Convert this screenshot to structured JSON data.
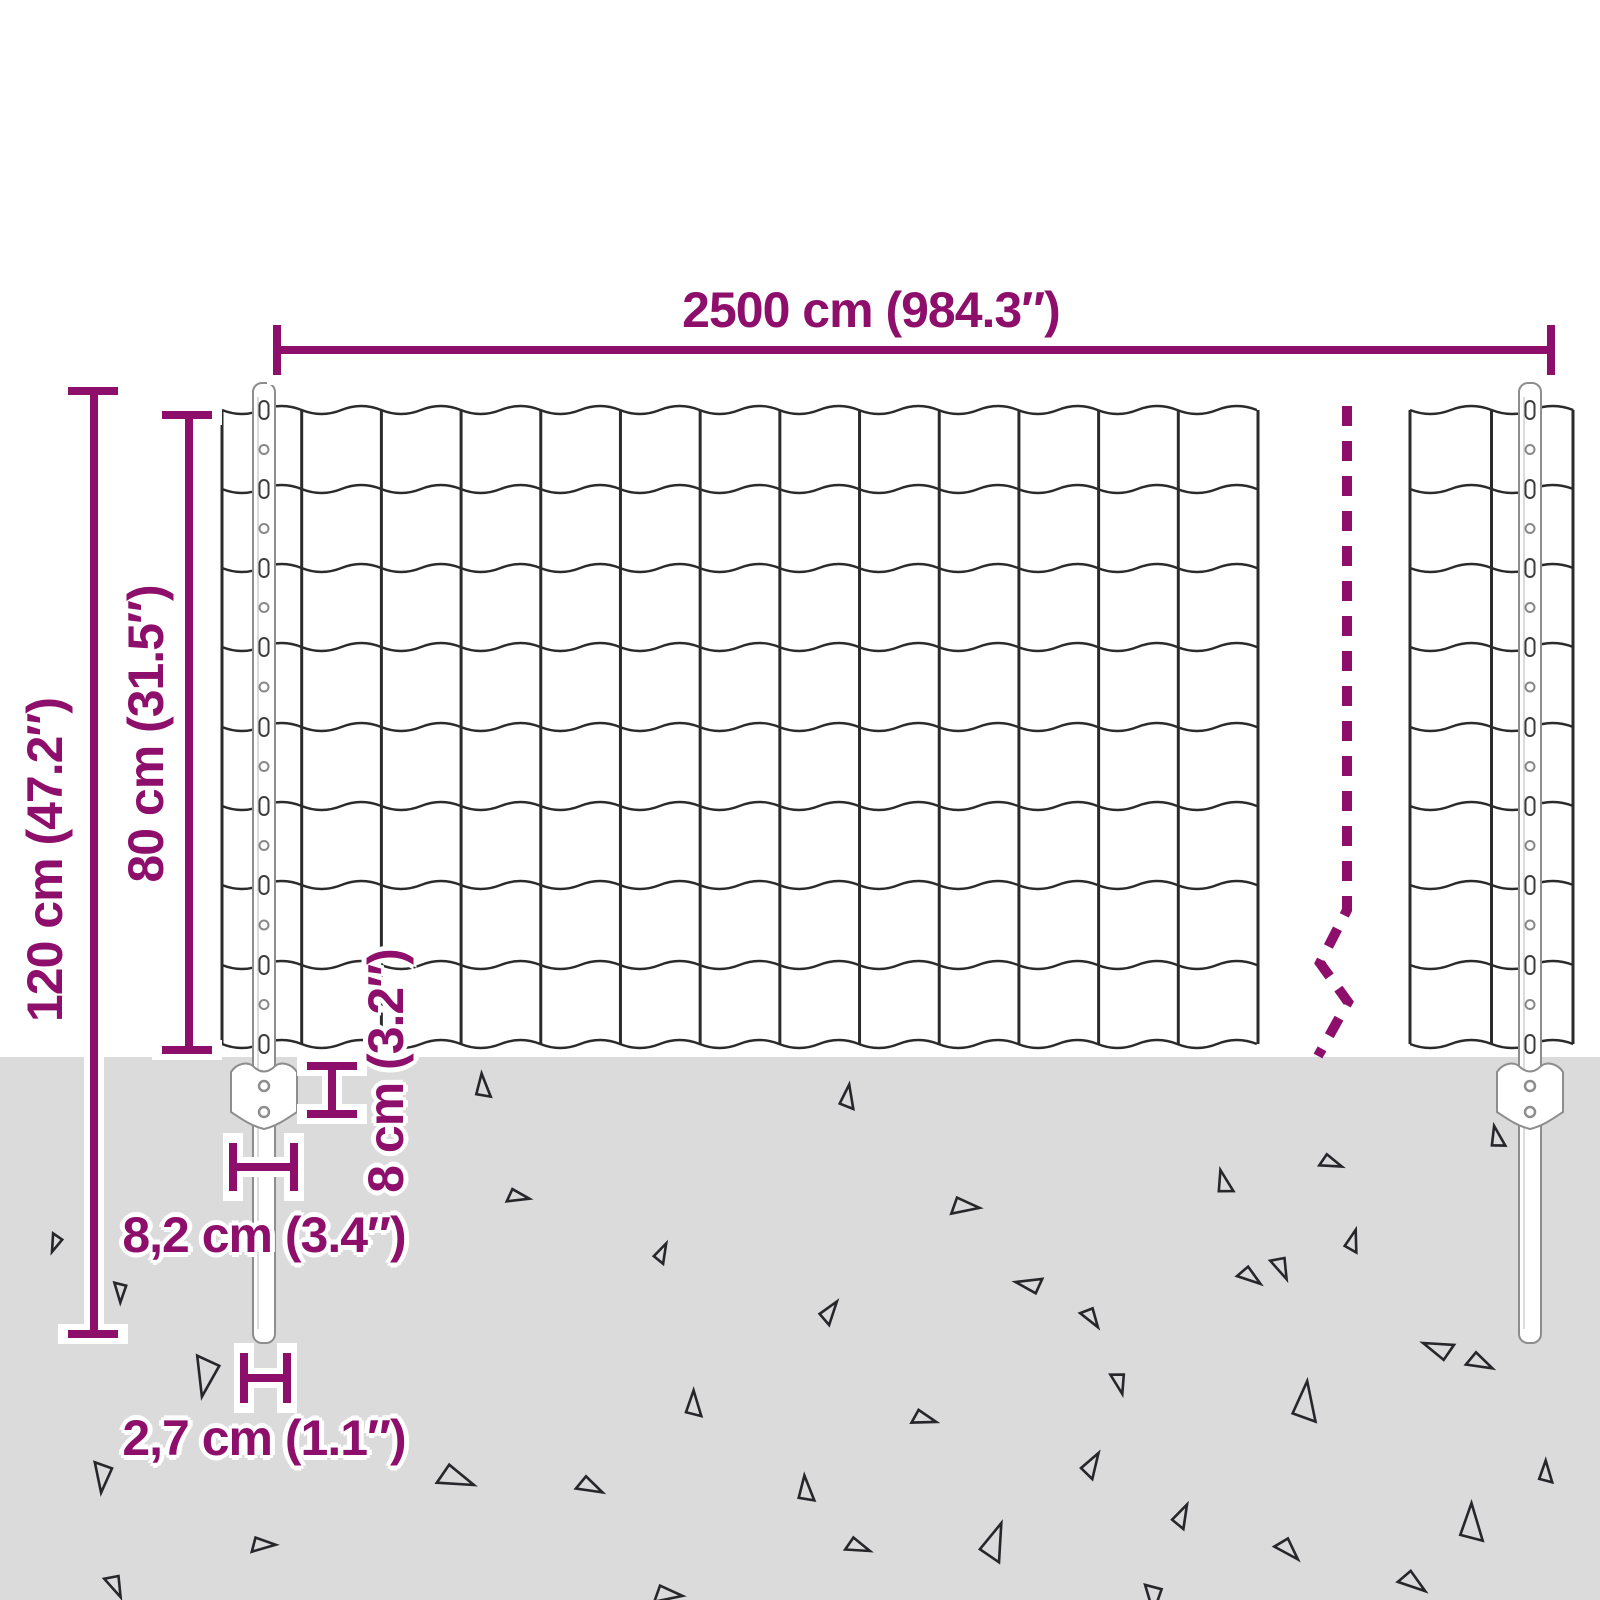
{
  "page": {
    "title": "Fence dimension diagram"
  },
  "labels": {
    "length": "2500 cm (984.3″)",
    "total_height": "120 cm (47.2″)",
    "mesh_height": "80 cm (31.5″)",
    "anchor_depth": "8 cm (3.2″)",
    "anchor_width": "8,2 cm (3.4″)",
    "post_width": "2,7 cm (1.1″)"
  },
  "colors": {
    "accent": "#8E0F6B",
    "halo": "#ffffff",
    "ground": "#dbdbdb",
    "wire": "#2b2b2b",
    "post_fill": "#ffffff",
    "post_stroke": "#8d8d8d",
    "triangle": "#26262b"
  },
  "diagram": {
    "canvas": {
      "w": 1600,
      "h": 1600
    },
    "ground": {
      "y": 1057
    },
    "wire_ys": [
      410,
      489,
      568,
      647,
      727,
      806,
      885,
      965,
      1044
    ],
    "wave_amp": 4,
    "meshes": [
      {
        "x0": 222,
        "x1": 1258,
        "cells": 13
      },
      {
        "x0": 1410,
        "x1": 1573,
        "cells": 2
      }
    ],
    "posts": [
      {
        "x": 253,
        "w": 22,
        "top": 383,
        "bottom": 1343
      },
      {
        "x": 1519,
        "w": 22,
        "top": 383,
        "bottom": 1343
      }
    ],
    "plates": [
      {
        "cx": 264,
        "top": 1062
      },
      {
        "cx": 1530,
        "top": 1062
      }
    ],
    "break_line": {
      "points": [
        [
          1347,
          406
        ],
        [
          1347,
          910
        ],
        [
          1320,
          963
        ],
        [
          1348,
          1002
        ],
        [
          1318,
          1056
        ]
      ],
      "dash": "20 15",
      "width": 10
    },
    "dimensions": [
      {
        "name": "length-dim",
        "path": "M277 325 V375 M277 350 H1551 M1551 325 V375"
      },
      {
        "name": "total-height-dim",
        "path": "M68 391 H118 M94 391 V1334 M68 1334 H118"
      },
      {
        "name": "mesh-height-dim",
        "path": "M162 415 H212 M189 415 V1050 M162 1050 H212"
      },
      {
        "name": "anchor-depth-dim",
        "path": "M307 1066 H357 M332 1066 V1114 M307 1114 H357"
      },
      {
        "name": "anchor-width-dim",
        "path": "M233 1143 V1191 M233 1167 H294 M294 1143 V1191"
      },
      {
        "name": "post-width-dim",
        "path": "M244 1353 V1403 M244 1378 H287 M287 1353 V1403"
      }
    ],
    "triangles": [
      [
        483,
        1086,
        24,
        0
      ],
      [
        848,
        1097,
        24,
        12
      ],
      [
        1497,
        1137,
        22,
        -8
      ],
      [
        518,
        1197,
        22,
        105
      ],
      [
        965,
        1207,
        28,
        100
      ],
      [
        55,
        1243,
        18,
        205
      ],
      [
        1224,
        1182,
        24,
        -10
      ],
      [
        1331,
        1163,
        22,
        115
      ],
      [
        662,
        1253,
        20,
        30
      ],
      [
        1029,
        1284,
        26,
        -75
      ],
      [
        1281,
        1268,
        24,
        160
      ],
      [
        120,
        1292,
        20,
        185
      ],
      [
        830,
        1312,
        24,
        40
      ],
      [
        1091,
        1318,
        22,
        150
      ],
      [
        1353,
        1241,
        22,
        20
      ],
      [
        1250,
        1277,
        24,
        130
      ],
      [
        1438,
        1348,
        30,
        -65
      ],
      [
        205,
        1376,
        40,
        195
      ],
      [
        1480,
        1363,
        26,
        120
      ],
      [
        694,
        1404,
        26,
        5
      ],
      [
        924,
        1419,
        24,
        110
      ],
      [
        1306,
        1402,
        40,
        10
      ],
      [
        1119,
        1383,
        22,
        170
      ],
      [
        102,
        1477,
        30,
        190
      ],
      [
        456,
        1479,
        36,
        115
      ],
      [
        590,
        1487,
        26,
        120
      ],
      [
        806,
        1489,
        26,
        0
      ],
      [
        1092,
        1465,
        26,
        35
      ],
      [
        1546,
        1472,
        22,
        5
      ],
      [
        263,
        1545,
        24,
        95
      ],
      [
        858,
        1547,
        24,
        115
      ],
      [
        995,
        1542,
        38,
        25
      ],
      [
        1182,
        1516,
        24,
        30
      ],
      [
        1472,
        1523,
        38,
        5
      ],
      [
        1288,
        1550,
        26,
        140
      ],
      [
        1413,
        1583,
        28,
        130
      ],
      [
        115,
        1586,
        24,
        160
      ],
      [
        668,
        1595,
        28,
        100
      ],
      [
        1153,
        1598,
        28,
        185
      ]
    ]
  }
}
